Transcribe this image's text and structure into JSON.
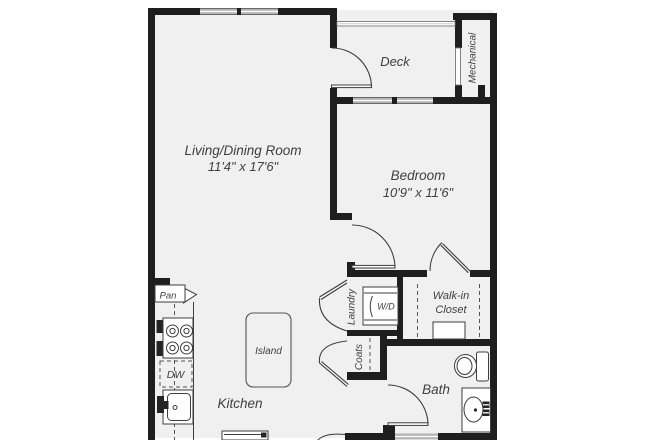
{
  "floor_plan": {
    "rooms": {
      "living_dining": {
        "name": "Living/Dining Room",
        "dimensions": "11'4\" x 17'6\""
      },
      "bedroom": {
        "name": "Bedroom",
        "dimensions": "10'9\" x 11'6\""
      },
      "deck": {
        "name": "Deck"
      },
      "mechanical": {
        "name": "Mechanical"
      },
      "kitchen": {
        "name": "Kitchen"
      },
      "bath": {
        "name": "Bath"
      },
      "walk_in_closet": {
        "line1": "Walk-in",
        "line2": "Closet"
      },
      "laundry": {
        "name": "Laundry"
      },
      "coats": {
        "name": "Coats"
      }
    },
    "labels": {
      "island": "Island",
      "pantry": "Pan",
      "dishwasher": "DW",
      "washer_dryer": "W/D"
    },
    "colors": {
      "wall": "#1e1e1e",
      "floor": "#f0f0f0",
      "window": "#b5b5b5",
      "line": "#3d3d3d",
      "text": "#3f3f3f"
    }
  }
}
